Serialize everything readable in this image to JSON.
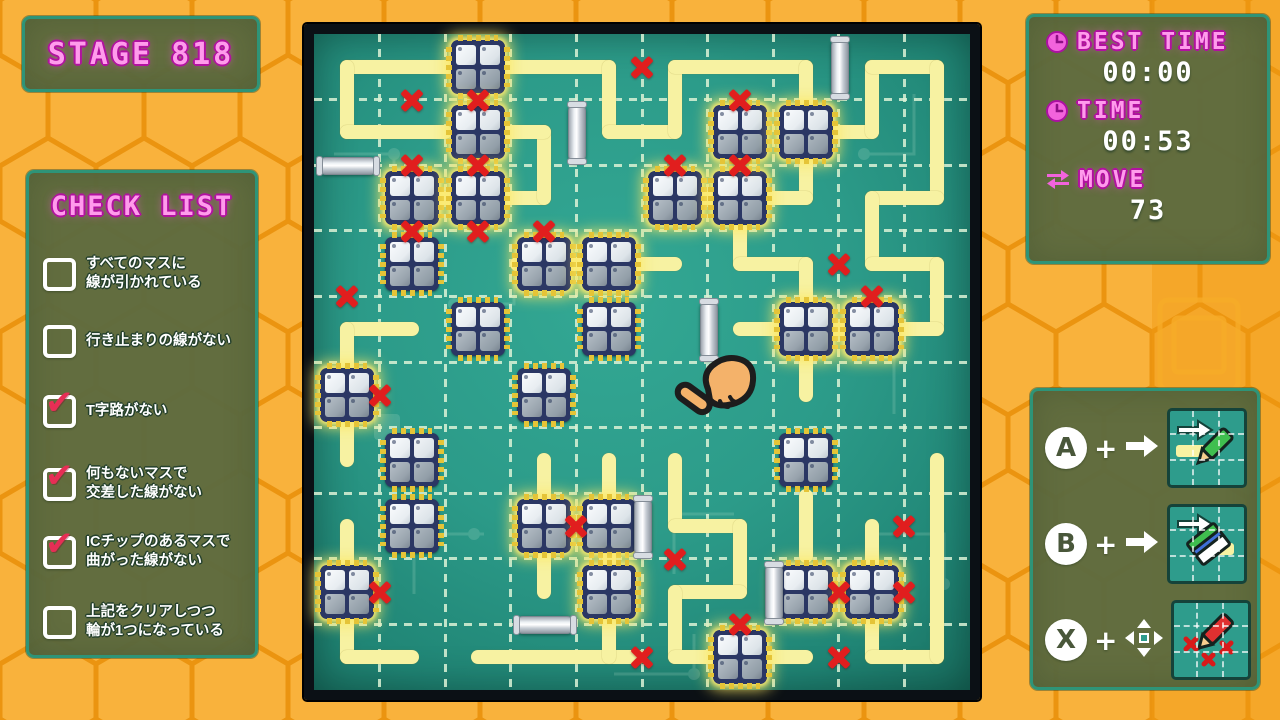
{
  "stage": {
    "label": "STAGE",
    "number": "818"
  },
  "checklist": {
    "title": "CHECK LIST",
    "items": [
      {
        "label": "すべてのマスに\n線が引かれている",
        "checked": false
      },
      {
        "label": "行き止まりの線がない",
        "checked": false
      },
      {
        "label": "T字路がない",
        "checked": true
      },
      {
        "label": "何もないマスで\n交差した線がない",
        "checked": true
      },
      {
        "label": "ICチップのあるマスで\n曲がった線がない",
        "checked": true
      },
      {
        "label": "上記をクリアしつつ\n輪が1つになっている",
        "checked": false
      }
    ]
  },
  "stats": {
    "best_time_label": "BEST TIME",
    "best_time_value": "00:00",
    "time_label": "TIME",
    "time_value": "00:53",
    "move_label": "MOVE",
    "move_value": "73"
  },
  "controls": {
    "plus": "+",
    "rows": [
      {
        "button": "A",
        "arrow": "right",
        "tool": "draw-line"
      },
      {
        "button": "B",
        "arrow": "right",
        "tool": "erase-line"
      },
      {
        "button": "X",
        "arrow": "4way",
        "tool": "mark-x"
      }
    ]
  },
  "colors": {
    "bg_orange": "#F7A823",
    "hex_stroke": "#EB9410",
    "panel_olive": "#5C6A40",
    "panel_border": "#2E9478",
    "accent_pink": "#FF9BEC",
    "board_teal": "#2C9B89",
    "wire_yellow": "#F7F2A2",
    "mark_red": "#E11E1E",
    "chip_navy": "#2B3764"
  },
  "board": {
    "grid": {
      "cols": 10,
      "rows": 10
    },
    "line_segments": [
      {
        "x1": 0,
        "y1": 0,
        "x2": 4,
        "y2": 0
      },
      {
        "x1": 0,
        "y1": 0,
        "x2": 0,
        "y2": 1
      },
      {
        "x1": 0,
        "y1": 1,
        "x2": 1.5,
        "y2": 1
      },
      {
        "x1": 4,
        "y1": 0,
        "x2": 4,
        "y2": 1
      },
      {
        "x1": 4,
        "y1": 1,
        "x2": 5,
        "y2": 1
      },
      {
        "x1": 5,
        "y1": 0,
        "x2": 5,
        "y2": 1
      },
      {
        "x1": 5,
        "y1": 0,
        "x2": 7,
        "y2": 0
      },
      {
        "x1": 7,
        "y1": 0,
        "x2": 7,
        "y2": 2
      },
      {
        "x1": 5,
        "y1": 2,
        "x2": 7,
        "y2": 2
      },
      {
        "x1": 7,
        "y1": 1,
        "x2": 8,
        "y2": 1
      },
      {
        "x1": 8,
        "y1": 0,
        "x2": 8,
        "y2": 1
      },
      {
        "x1": 8,
        "y1": 0,
        "x2": 9,
        "y2": 0
      },
      {
        "x1": 9,
        "y1": 0,
        "x2": 9,
        "y2": 2
      },
      {
        "x1": 8,
        "y1": 2,
        "x2": 9,
        "y2": 2
      },
      {
        "x1": 8,
        "y1": 2,
        "x2": 8,
        "y2": 3
      },
      {
        "x1": 8,
        "y1": 3,
        "x2": 9,
        "y2": 3
      },
      {
        "x1": 9,
        "y1": 3,
        "x2": 9,
        "y2": 4
      },
      {
        "x1": 6,
        "y1": 4,
        "x2": 9,
        "y2": 4
      },
      {
        "x1": 6,
        "y1": 2.45,
        "x2": 6,
        "y2": 3
      },
      {
        "x1": 6,
        "y1": 3,
        "x2": 7,
        "y2": 3
      },
      {
        "x1": 7,
        "y1": 3,
        "x2": 7,
        "y2": 5
      },
      {
        "x1": 0.75,
        "y1": 2,
        "x2": 3,
        "y2": 2
      },
      {
        "x1": 3,
        "y1": 1,
        "x2": 3,
        "y2": 2
      },
      {
        "x1": 2,
        "y1": 1,
        "x2": 3,
        "y2": 1
      },
      {
        "x1": 2.6,
        "y1": 3,
        "x2": 5,
        "y2": 3
      },
      {
        "x1": 0,
        "y1": 4,
        "x2": 1,
        "y2": 4
      },
      {
        "x1": 0,
        "y1": 4,
        "x2": 0,
        "y2": 6
      },
      {
        "x1": 0,
        "y1": 7,
        "x2": 0,
        "y2": 9
      },
      {
        "x1": 0,
        "y1": 9,
        "x2": 1,
        "y2": 9
      },
      {
        "x1": 2,
        "y1": 9,
        "x2": 4.45,
        "y2": 9
      },
      {
        "x1": 4,
        "y1": 6,
        "x2": 4,
        "y2": 9
      },
      {
        "x1": 3,
        "y1": 6,
        "x2": 3,
        "y2": 8
      },
      {
        "x1": 5,
        "y1": 6,
        "x2": 5,
        "y2": 7
      },
      {
        "x1": 5,
        "y1": 7,
        "x2": 6,
        "y2": 7
      },
      {
        "x1": 6,
        "y1": 7,
        "x2": 6,
        "y2": 8
      },
      {
        "x1": 5,
        "y1": 8,
        "x2": 6,
        "y2": 8
      },
      {
        "x1": 5,
        "y1": 8,
        "x2": 5,
        "y2": 9
      },
      {
        "x1": 5,
        "y1": 9,
        "x2": 7,
        "y2": 9
      },
      {
        "x1": 7,
        "y1": 6.55,
        "x2": 7,
        "y2": 7.45
      },
      {
        "x1": 8,
        "y1": 7,
        "x2": 8,
        "y2": 9
      },
      {
        "x1": 8,
        "y1": 9,
        "x2": 9,
        "y2": 9
      },
      {
        "x1": 9,
        "y1": 6,
        "x2": 9,
        "y2": 9
      }
    ],
    "chips": [
      {
        "c": 2,
        "r": 0,
        "glow": true
      },
      {
        "c": 2,
        "r": 1,
        "glow": true
      },
      {
        "c": 1,
        "r": 2,
        "glow": true
      },
      {
        "c": 2,
        "r": 2,
        "glow": true
      },
      {
        "c": 1,
        "r": 3,
        "glow": false
      },
      {
        "c": 3,
        "r": 3,
        "glow": true
      },
      {
        "c": 4,
        "r": 3,
        "glow": true
      },
      {
        "c": 5,
        "r": 2,
        "glow": true
      },
      {
        "c": 6,
        "r": 2,
        "glow": true
      },
      {
        "c": 6,
        "r": 1,
        "glow": true
      },
      {
        "c": 7,
        "r": 1,
        "glow": true
      },
      {
        "c": 2,
        "r": 4,
        "glow": false
      },
      {
        "c": 4,
        "r": 4,
        "glow": false
      },
      {
        "c": 7,
        "r": 4,
        "glow": true
      },
      {
        "c": 8,
        "r": 4,
        "glow": true
      },
      {
        "c": 0,
        "r": 5,
        "glow": true
      },
      {
        "c": 3,
        "r": 5,
        "glow": false
      },
      {
        "c": 1,
        "r": 6,
        "glow": false
      },
      {
        "c": 7,
        "r": 6,
        "glow": false
      },
      {
        "c": 1,
        "r": 7,
        "glow": false
      },
      {
        "c": 3,
        "r": 7,
        "glow": true
      },
      {
        "c": 4,
        "r": 7,
        "glow": true
      },
      {
        "c": 0,
        "r": 8,
        "glow": true
      },
      {
        "c": 4,
        "r": 8,
        "glow": true
      },
      {
        "c": 7,
        "r": 8,
        "glow": true
      },
      {
        "c": 8,
        "r": 8,
        "glow": true
      },
      {
        "c": 6,
        "r": 9,
        "glow": true
      }
    ],
    "x_marks": [
      {
        "c": 1,
        "r": 0.5
      },
      {
        "c": 2,
        "r": 0.5
      },
      {
        "c": 1,
        "r": 1.5
      },
      {
        "c": 2,
        "r": 1.5
      },
      {
        "c": 1,
        "r": 2.5
      },
      {
        "c": 2,
        "r": 2.5
      },
      {
        "c": 3,
        "r": 2.5
      },
      {
        "c": 4.5,
        "r": 0
      },
      {
        "c": 6,
        "r": 0.5
      },
      {
        "c": 5,
        "r": 1.5
      },
      {
        "c": 6,
        "r": 1.5
      },
      {
        "c": 7.5,
        "r": 3
      },
      {
        "c": 8,
        "r": 3.5
      },
      {
        "c": 0,
        "r": 3.5
      },
      {
        "c": 0.5,
        "r": 5
      },
      {
        "c": 0.5,
        "r": 8
      },
      {
        "c": 3.5,
        "r": 7
      },
      {
        "c": 4.5,
        "r": 9
      },
      {
        "c": 5,
        "r": 7.5
      },
      {
        "c": 6,
        "r": 8.5
      },
      {
        "c": 7.5,
        "r": 8
      },
      {
        "c": 8.5,
        "r": 8
      },
      {
        "c": 7.5,
        "r": 9
      },
      {
        "c": 8.5,
        "r": 7
      }
    ],
    "capsules": [
      {
        "c": 0,
        "r": 1.5,
        "o": "h"
      },
      {
        "c": 3.5,
        "r": 1,
        "o": "v"
      },
      {
        "c": 7.5,
        "r": 0,
        "o": "v"
      },
      {
        "c": 5.5,
        "r": 4,
        "o": "v"
      },
      {
        "c": 4.5,
        "r": 7,
        "o": "v"
      },
      {
        "c": 6.5,
        "r": 8,
        "o": "v"
      },
      {
        "c": 3,
        "r": 8.5,
        "o": "h"
      }
    ],
    "cursor": {
      "x": 5.38,
      "y": 4.6
    }
  }
}
